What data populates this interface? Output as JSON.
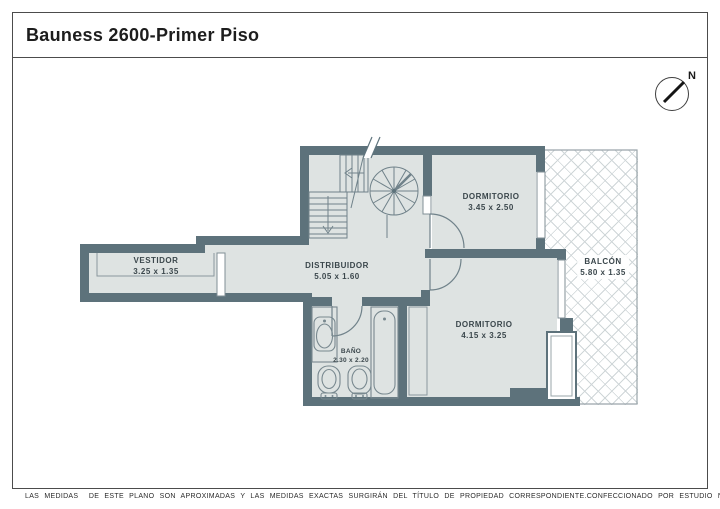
{
  "title": "Bauness 2600-Primer Piso",
  "north_label": "N",
  "rooms": {
    "vestidor": {
      "name": "VESTIDOR",
      "dims": "3.25 x 1.35"
    },
    "distribuidor": {
      "name": "DISTRIBUIDOR",
      "dims": "5.05 x 1.60"
    },
    "dormitorio1": {
      "name": "DORMITORIO",
      "dims": "3.45 x 2.50"
    },
    "dormitorio2": {
      "name": "DORMITORIO",
      "dims": "4.15 x 3.25"
    },
    "balcon": {
      "name": "BALCÓN",
      "dims": "5.80 x 1.35"
    },
    "bano": {
      "name": "BAÑO",
      "dims": "2.30 x 2.20"
    }
  },
  "footer": {
    "disclaimer": "LAS MEDIDAS  DE ESTE PLANO SON APROXIMADAS Y LAS MEDIDAS EXACTAS SURGIRÁN DEL TÍTULO DE PROPIEDAD CORRESPONDIENTE.",
    "credit": "CONFECCIONADO POR ESTUDIO NARTEX"
  },
  "colors": {
    "wall": "#5d727b",
    "floor": "#dee3e2",
    "fixture_line": "#78888f",
    "lattice_line": "#cfd6d8",
    "frame_border": "#4c4c4c"
  }
}
